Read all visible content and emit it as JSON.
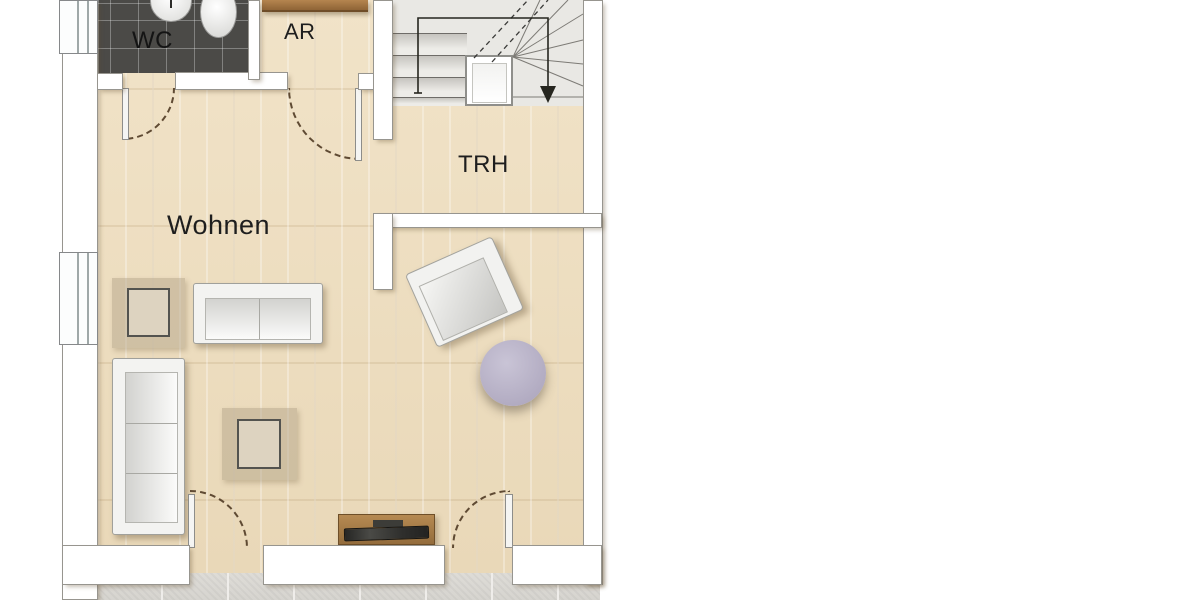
{
  "plan": {
    "type": "floor-plan",
    "rooms": [
      {
        "id": "wc",
        "label": "WC"
      },
      {
        "id": "ar",
        "label": "AR"
      },
      {
        "id": "trh",
        "label": "TRH"
      },
      {
        "id": "wohnen",
        "label": "Wohnen"
      }
    ],
    "stairs": {
      "symbol": "walking-line-with-down-arrow",
      "direction": "down"
    },
    "doors": [
      {
        "room": "wc",
        "type": "swing"
      },
      {
        "room": "ar",
        "type": "swing"
      },
      {
        "room": "wohnen",
        "type": "swing-terrace-left"
      },
      {
        "room": "wohnen",
        "type": "swing-terrace-right"
      }
    ],
    "windows": [
      {
        "wall": "left",
        "position": "top"
      },
      {
        "wall": "left",
        "position": "middle"
      }
    ],
    "furniture": [
      {
        "name": "shelf",
        "room": "ar"
      },
      {
        "name": "sink",
        "room": "wc"
      },
      {
        "name": "toilet",
        "room": "wc"
      },
      {
        "name": "two-seat-sofa",
        "room": "wohnen"
      },
      {
        "name": "three-seat-sofa",
        "room": "wohnen"
      },
      {
        "name": "coffee-table",
        "room": "wohnen"
      },
      {
        "name": "coffee-table",
        "room": "wohnen"
      },
      {
        "name": "armchair",
        "room": "wohnen"
      },
      {
        "name": "round-side-table",
        "room": "wohnen"
      },
      {
        "name": "tv-sideboard",
        "room": "wohnen"
      }
    ],
    "colors": {
      "wall": "#ffffff",
      "wall_outline": "#97958f",
      "wood_floor": "#eddebf",
      "wc_tiles": "#4b4a47",
      "stair_floor": "#e9e8e4",
      "terrace_tiles": "#dbd9d4",
      "door_arc": "#5f4a33",
      "round_table": "#b3adc3",
      "sideboard": "#a97c4e",
      "label_text": "#1e1e1e"
    }
  }
}
